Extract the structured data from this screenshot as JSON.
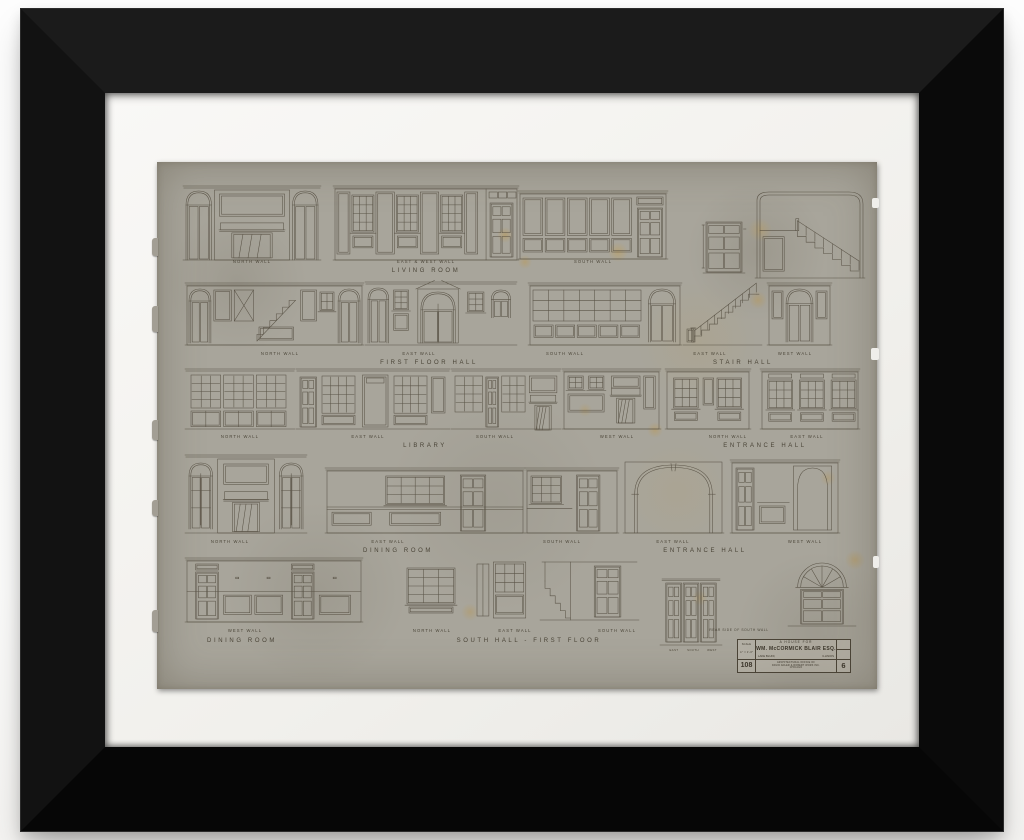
{
  "colors": {
    "frame": "#0d0d0d",
    "mat": "#f4f3ef",
    "paper": "#a8a59b",
    "ink": "#4d4639",
    "label_ink": "#443e31"
  },
  "title_block": {
    "heading": "A HOUSE FOR",
    "client": "WM. McCORMICK BLAIR ESQ.",
    "location_left": "LAKE BLUFF,",
    "location_right": "ILLINOIS",
    "scale_lines": [
      "SCALE",
      "¾″ = 1′-0″"
    ],
    "drawing_no": "108",
    "office_lines": [
      "ARCHITECTURAL OFFICE OF",
      "DAVID ADLER & ROBERT WORK INC.",
      "CHICAGO"
    ],
    "sheet_no": "6",
    "note_above": "REAR SIDE OF SOUTH WALL"
  },
  "rows": [
    {
      "walls": [
        "NORTH WALL",
        "EAST & WEST WALL",
        "SOUTH WALL"
      ],
      "rooms": [
        "LIVING ROOM"
      ]
    },
    {
      "walls": [
        "NORTH WALL",
        "EAST WALL",
        "SOUTH WALL",
        "EAST WALL",
        "WEST WALL"
      ],
      "rooms": [
        "FIRST FLOOR HALL",
        "STAIR HALL"
      ]
    },
    {
      "walls": [
        "NORTH WALL",
        "EAST WALL",
        "SOUTH WALL",
        "WEST WALL",
        "NORTH WALL",
        "EAST WALL"
      ],
      "rooms": [
        "LIBRARY",
        "ENTRANCE HALL"
      ]
    },
    {
      "walls": [
        "NORTH WALL",
        "EAST WALL",
        "SOUTH WALL",
        "EAST WALL",
        "WEST WALL"
      ],
      "rooms": [
        "DINING ROOM",
        "ENTRANCE HALL"
      ]
    },
    {
      "walls": [
        "WEST WALL",
        "NORTH WALL",
        "EAST WALL",
        "SOUTH WALL"
      ],
      "rooms": [
        "DINING ROOM",
        "SOUTH HALL - FIRST FLOOR"
      ],
      "door_labels": [
        "EAST",
        "SOUTH",
        "WEST"
      ]
    }
  ]
}
